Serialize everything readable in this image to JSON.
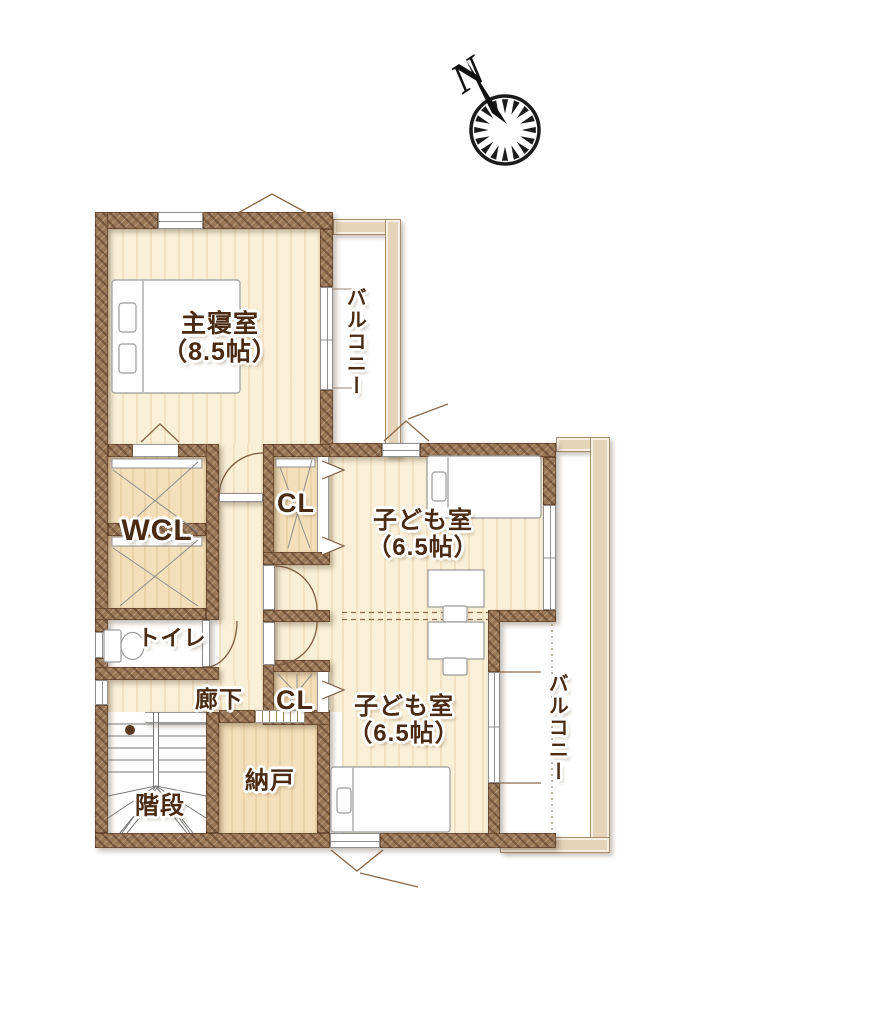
{
  "compass": {
    "north_label": "N"
  },
  "rooms": {
    "master": {
      "name": "主寝室",
      "size": "（8.5帖）"
    },
    "balcony_top": {
      "name": "バルコニー"
    },
    "wcl": {
      "name": "WCL"
    },
    "cl_upper": {
      "name": "CL"
    },
    "kids1": {
      "name": "子ども室",
      "size": "（6.5帖）"
    },
    "toilet": {
      "name": "トイレ"
    },
    "hallway": {
      "name": "廊下"
    },
    "cl_lower": {
      "name": "CL"
    },
    "kids2": {
      "name": "子ども室",
      "size": "（6.5帖）"
    },
    "balcony_right": {
      "name": "バルコニー"
    },
    "storage": {
      "name": "納戸"
    },
    "stairs": {
      "name": "階段"
    }
  },
  "colors": {
    "wall": "#9a7757",
    "floor": "#faf0d8",
    "closet": "#f3dfb9",
    "balcony_band": "#e5d4ba",
    "label_text": "#4a2a12",
    "compass_ink": "#1b1b1b"
  }
}
